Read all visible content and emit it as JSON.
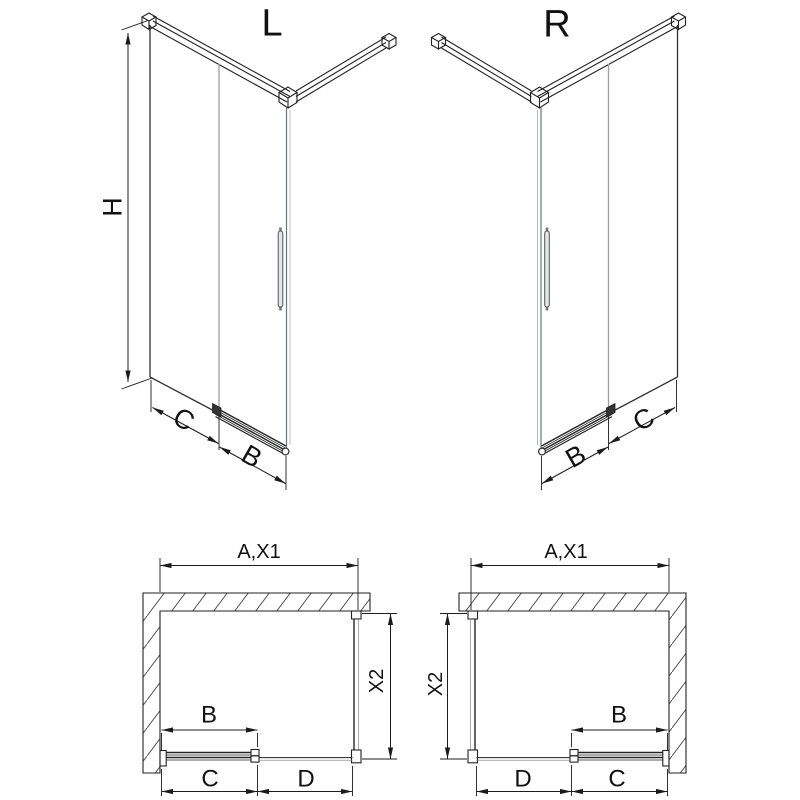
{
  "drawing": {
    "background": "#ffffff",
    "line_color": "#222222",
    "glass_color": "#9aa0a4",
    "hatch_color": "#555555"
  },
  "views": {
    "iso_left": {
      "title": "L",
      "height_label": "H",
      "fixed_label": "C",
      "door_label": "B"
    },
    "iso_right": {
      "title": "R",
      "fixed_label": "C",
      "door_label": "B"
    },
    "plan_left": {
      "width_label": "A,X1",
      "depth_label": "X2",
      "door_label": "B",
      "seg_c_label": "C",
      "seg_d_label": "D"
    },
    "plan_right": {
      "width_label": "A,X1",
      "depth_label": "X2",
      "door_label": "B",
      "seg_c_label": "C",
      "seg_d_label": "D"
    }
  }
}
